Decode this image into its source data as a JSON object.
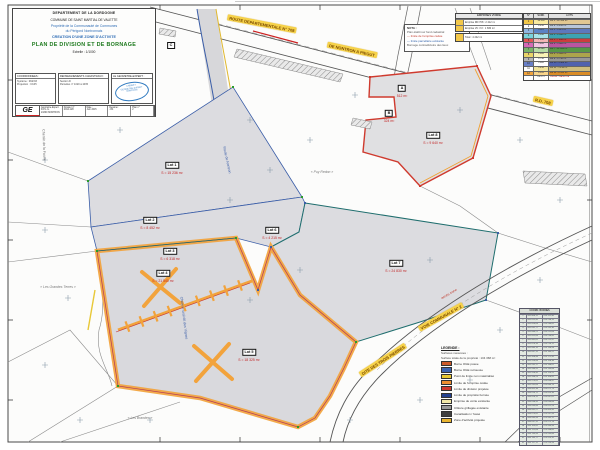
{
  "title_block": {
    "department": "DEPARTEMENT DE LA DORDOGNE",
    "commune": "COMMUNE DE SAINT MARTIAL DE VALETTE",
    "owner_line1": "Propriété de la Communauté de Communes",
    "owner_line2": "du Périgord Nontronnais",
    "project": "CREATION D'UNE ZONE D'ACTIVITE",
    "plan_title": "PLAN DE DIVISION ET DE BORNAGE",
    "scale": "Echelle : 1/1000",
    "box1_header": "COORDONNEES :",
    "box1_lines": [
      "Système : RGF93",
      "Projection : CC45"
    ],
    "box2_header": "RENSEIGNEMENTS CADASTRAUX :",
    "box2_lines": [
      "Section D",
      "Parcelles n° 1020 à 1035"
    ],
    "box3_header": "LE GEOMETRE-EXPERT :",
    "stamp_lines": [
      "CABINET",
      "GEOMETRE-EXPERT",
      "NONTRON"
    ],
    "logo": "GE",
    "strip_cells": [
      {
        "l1": "Géomètre-Expert D.P.L.G.",
        "l2": "24300 NONTRON"
      },
      {
        "l1": "Dossier n°",
        "l2": "2014-128"
      },
      {
        "l1": "Date :",
        "l2": "Juin 2015"
      },
      {
        "l1": "Dessiné :",
        "l2": "J.M."
      },
      {
        "l1": "Plan n°",
        "l2": "2"
      }
    ]
  },
  "top_note": {
    "lines": [
      {
        "c": "#333333",
        "t": "NOTA :"
      },
      {
        "c": "#555555",
        "t": "Plan établi sur fond cadastral"
      },
      {
        "c": "#c0392b",
        "t": "— limite de l'emprise cédée"
      },
      {
        "c": "#2e5fa8",
        "t": "— limite parcellaire existante"
      },
      {
        "c": "#555555",
        "t": "Bornage contradictoire des lieux"
      }
    ]
  },
  "mini_table": {
    "header": "EMPRISES VOIRIE",
    "rows": [
      {
        "sw": "#f3c84a",
        "t": "Emprise RD 708 : 2 412 m²"
      },
      {
        "sw": "#f3c84a",
        "t": "Emprise VC n°2 : 1 830 m²"
      }
    ],
    "extra": {
      "sw": "#f3c84a",
      "t": "Total : 4 242 m²"
    }
  },
  "color_table": {
    "headers": [
      "N°",
      "SURF.",
      "LOTS"
    ],
    "rows": [
      {
        "n": "1",
        "s": "12 450",
        "l": "Lot 1 - 12 450 m²",
        "c1": "#f3c84a",
        "c2": "#faeaa0",
        "c3": "#e2c792",
        "red": false
      },
      {
        "n": "2",
        "s": "8 230",
        "l": "Lot 2 - 8 230 m²",
        "c1": "#ffffff",
        "c2": "#ffffff",
        "c3": "#b9c6da",
        "red": false
      },
      {
        "n": "3",
        "s": "6 115",
        "l": "Lot 3 - 6 115 m²",
        "c1": "#8fb6e2",
        "c2": "#5b82c4",
        "c3": "#5d78bd",
        "red": false
      },
      {
        "n": "4",
        "s": "9 840",
        "l": "Lot 4 - 9 840 m²",
        "c1": "#79d2da",
        "c2": "#a8e4ea",
        "c3": "#3da4b2",
        "red": false
      },
      {
        "n": "5",
        "s": "7 260",
        "l": "Lot 5 - 7 260 m²",
        "c1": "#e25555",
        "c2": "#f2b4b4",
        "c3": "#cc3d3d",
        "red": false
      },
      {
        "n": "6",
        "s": "5 480",
        "l": "Lot 6 - 5 480 m²",
        "c1": "#d468b6",
        "c2": "#f2c6e2",
        "c3": "#bb55a0",
        "red": false
      },
      {
        "n": "7",
        "s": "11 020",
        "l": "Lot 7 - 11 020 m²",
        "c1": "#79b468",
        "c2": "#b6dca6",
        "c3": "#579646",
        "red": false
      },
      {
        "n": "8",
        "s": "4 895",
        "l": "Lot 8 - 4 895 m²",
        "c1": "#e9d468",
        "c2": "#f8f2b6",
        "c3": "#aca44b",
        "red": false
      },
      {
        "n": "9",
        "s": "6 740",
        "l": "Lot 9 - 6 740 m²",
        "c1": "#b5b5b5",
        "c2": "#ffffff",
        "c3": "#979797",
        "red": false
      },
      {
        "n": "10",
        "s": "3 980",
        "l": "Lot 10 - 3 980 m²",
        "c1": "#6a80c6",
        "c2": "#ffffff",
        "c3": "#5062ad",
        "red": false
      },
      {
        "n": "11",
        "s": "5 210",
        "l": "Lot 11 - 5 210 m²",
        "c1": "#ffffff",
        "c2": "#f2e49a",
        "c3": "#cdbd7e",
        "red": false
      },
      {
        "n": "12",
        "s": "8 655",
        "l": "Lot 12 - 8 655 m²",
        "c1": "#f2a43c",
        "c2": "#f8d48a",
        "c3": "#da8c26",
        "red": false
      },
      {
        "n": "",
        "s": "89 875",
        "l": "TOTAL : 89 875 m²",
        "c1": "#ffffff",
        "c2": "#ffffff",
        "c3": "#ffffff",
        "red": true
      }
    ]
  },
  "legend": {
    "title": "LEGENDE :",
    "note1": "Surfaces mesurées :",
    "note2": "Surface totale de la propriété : 104 368 m²",
    "items": [
      {
        "c": "#cc5a2a",
        "t": "Borne OGE posée"
      },
      {
        "c": "#3a62b0",
        "t": "Borne OGE retrouvée"
      },
      {
        "c": "#e8c832",
        "t": "Point de limite non matérialisé"
      },
      {
        "c": "#f09030",
        "t": "Limite de l'emprise cédée"
      },
      {
        "c": "#cf3a2e",
        "t": "Limite de division projetée"
      },
      {
        "c": "#23408f",
        "t": "Limite de propriété bornée"
      },
      {
        "c": "#f2e8a8",
        "t": "Emprise de voirie existante"
      },
      {
        "c": "#9a9a9a",
        "t": "Clôture grillagée existante"
      },
      {
        "c": "#404040",
        "t": "Canalisation / fossé"
      },
      {
        "c": "#e8b430",
        "t": "Zone d'activité projetée"
      }
    ]
  },
  "coord_table": {
    "header": "COORD. BORNES",
    "rows": [
      [
        "1",
        "495 806,12",
        "474 312,40"
      ],
      [
        "2",
        "495 812,45",
        "474 298,15"
      ],
      [
        "3",
        "495 820,08",
        "474 280,62"
      ],
      [
        "4",
        "495 831,77",
        "474 265,30"
      ],
      [
        "5",
        "495 840,21",
        "474 251,08"
      ],
      [
        "6",
        "495 852,64",
        "474 236,85"
      ],
      [
        "7",
        "495 861,02",
        "474 222,47"
      ],
      [
        "8",
        "495 874,39",
        "474 210,11"
      ],
      [
        "9",
        "495 885,70",
        "474 196,58"
      ],
      [
        "10",
        "495 897,15",
        "474 183,22"
      ],
      [
        "11",
        "495 908,48",
        "474 171,90"
      ],
      [
        "12",
        "495 920,83",
        "474 158,36"
      ],
      [
        "13",
        "495 932,17",
        "474 146,02"
      ],
      [
        "14",
        "495 944,55",
        "474 133,68"
      ],
      [
        "15",
        "495 956,90",
        "474 120,25"
      ],
      [
        "16",
        "495 968,24",
        "474 108,81"
      ],
      [
        "17",
        "495 979,61",
        "474 096,47"
      ],
      [
        "18",
        "495 991,06",
        "474 084,13"
      ],
      [
        "19",
        "496 002,38",
        "474 071,79"
      ],
      [
        "20",
        "496 014,72",
        "474 059,36"
      ],
      [
        "21",
        "496 026,15",
        "474 047,02"
      ],
      [
        "22",
        "496 038,50",
        "474 034,68"
      ],
      [
        "23",
        "496 049,84",
        "474 022,24"
      ],
      [
        "24",
        "496 061,27",
        "474 009,90"
      ],
      [
        "25",
        "496 073,62",
        "473 997,56"
      ],
      [
        "26",
        "496 085,96",
        "473 985,12"
      ],
      [
        "27",
        "496 097,31",
        "473 972,78"
      ],
      [
        "28",
        "496 109,65",
        "473 960,44"
      ],
      [
        "29",
        "496 121,08",
        "473 948,00"
      ],
      [
        "30",
        "496 133,43",
        "473 935,66"
      ],
      [
        "31",
        "496 145,77",
        "473 923,32"
      ],
      [
        "32",
        "496 157,12",
        "473 910,98"
      ]
    ]
  },
  "map": {
    "lots": [
      {
        "id": "Lot 1",
        "area": "S = 15 236 m²",
        "x": 172,
        "y": 164
      },
      {
        "id": "Lot 2",
        "area": "S = 8 452 m²",
        "x": 150,
        "y": 219
      },
      {
        "id": "Lot 3",
        "area": "S = 6 318 m²",
        "x": 170,
        "y": 250
      },
      {
        "id": "Lot 4",
        "area": "S = 21 540 m²",
        "x": 163,
        "y": 272
      },
      {
        "id": "Lot 5",
        "area": "S = 18 325 m²",
        "x": 249,
        "y": 351
      },
      {
        "id": "Lot 6",
        "area": "S = 4 215 m²",
        "x": 272,
        "y": 229
      },
      {
        "id": "Lot 7",
        "area": "S = 24 830 m²",
        "x": 396,
        "y": 262
      },
      {
        "id": "Lot 8",
        "area": "S = 9 640 m²",
        "x": 433,
        "y": 134
      },
      {
        "id": "A",
        "area": "512 m²",
        "x": 402,
        "y": 87
      },
      {
        "id": "B",
        "area": "324 m²",
        "x": 389,
        "y": 112
      },
      {
        "id": "C",
        "area": "",
        "x": 171,
        "y": 42
      }
    ],
    "road_labels": [
      {
        "t": "ROUTE DEPARTEMENTALE N° 708",
        "x": 262,
        "y": 24,
        "r": 11
      },
      {
        "t": "DE NONTRON A PIEGUT",
        "x": 352,
        "y": 50,
        "r": 12
      },
      {
        "t": "R.D. 708",
        "x": 543,
        "y": 101,
        "r": 13
      },
      {
        "t": "VOIE COMMUNALE N° 2",
        "x": 441,
        "y": 317,
        "r": -29
      },
      {
        "t": "DITE DES TROIS PIERRES",
        "x": 383,
        "y": 360,
        "r": -33
      }
    ],
    "street_labels": [
      {
        "t": "Route de Nontron",
        "x": 227,
        "y": 160,
        "r": 78,
        "c": "#3b5ea8"
      },
      {
        "t": "Chemin rural dit des Vignes",
        "x": 184,
        "y": 318,
        "r": 83,
        "c": "#3b5ea8"
      },
      {
        "t": "Chemin de la Faurie",
        "x": 44,
        "y": 145,
        "r": 88,
        "c": "#666666"
      },
      {
        "t": "accès zone",
        "x": 449,
        "y": 294,
        "r": -30,
        "c": "#c0392b"
      }
    ],
    "lieux_dits": [
      {
        "t": "« Les Grandes Terres »",
        "x": 58,
        "y": 287
      },
      {
        "t": "« Puy Redon »",
        "x": 322,
        "y": 172
      },
      {
        "t": "« Les Brandes »",
        "x": 140,
        "y": 418
      }
    ],
    "colors": {
      "parcel_fill": "#dcdce0",
      "orange_boundary": "#f2a33c",
      "red_boundary": "#cf3a2e",
      "blue_line": "#3b5ea8",
      "teal_line": "#1f6e6e",
      "yellow_label_bg": "#f6d24a"
    }
  }
}
